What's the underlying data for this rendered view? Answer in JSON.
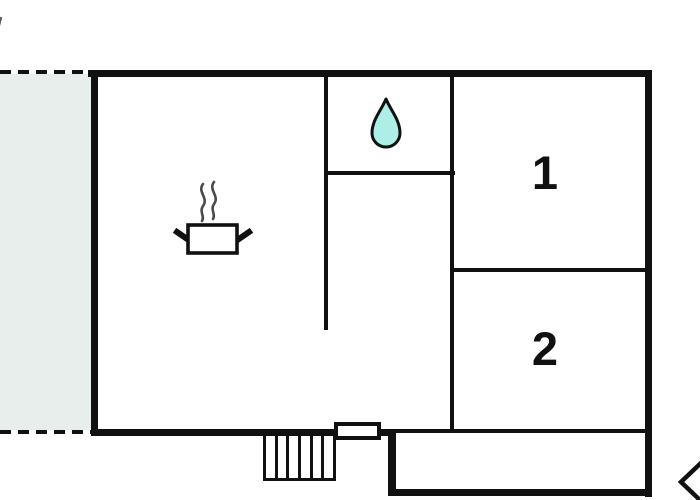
{
  "rooms": [
    {
      "label": "1"
    },
    {
      "label": "2"
    }
  ],
  "icons": {
    "water_drop": "water-drop-icon",
    "cooking_pot": "cooking-pot-icon",
    "steam": "steam-icon",
    "entrance_arrow": "entrance-arrow-icon"
  },
  "colors": {
    "wall": "#111111",
    "water_drop_fill": "#adefe7",
    "terrace_fill": "#e8eeeb",
    "steam": "#4a4a4a",
    "background": "#ffffff"
  },
  "stairs": {
    "step_count": 6
  }
}
